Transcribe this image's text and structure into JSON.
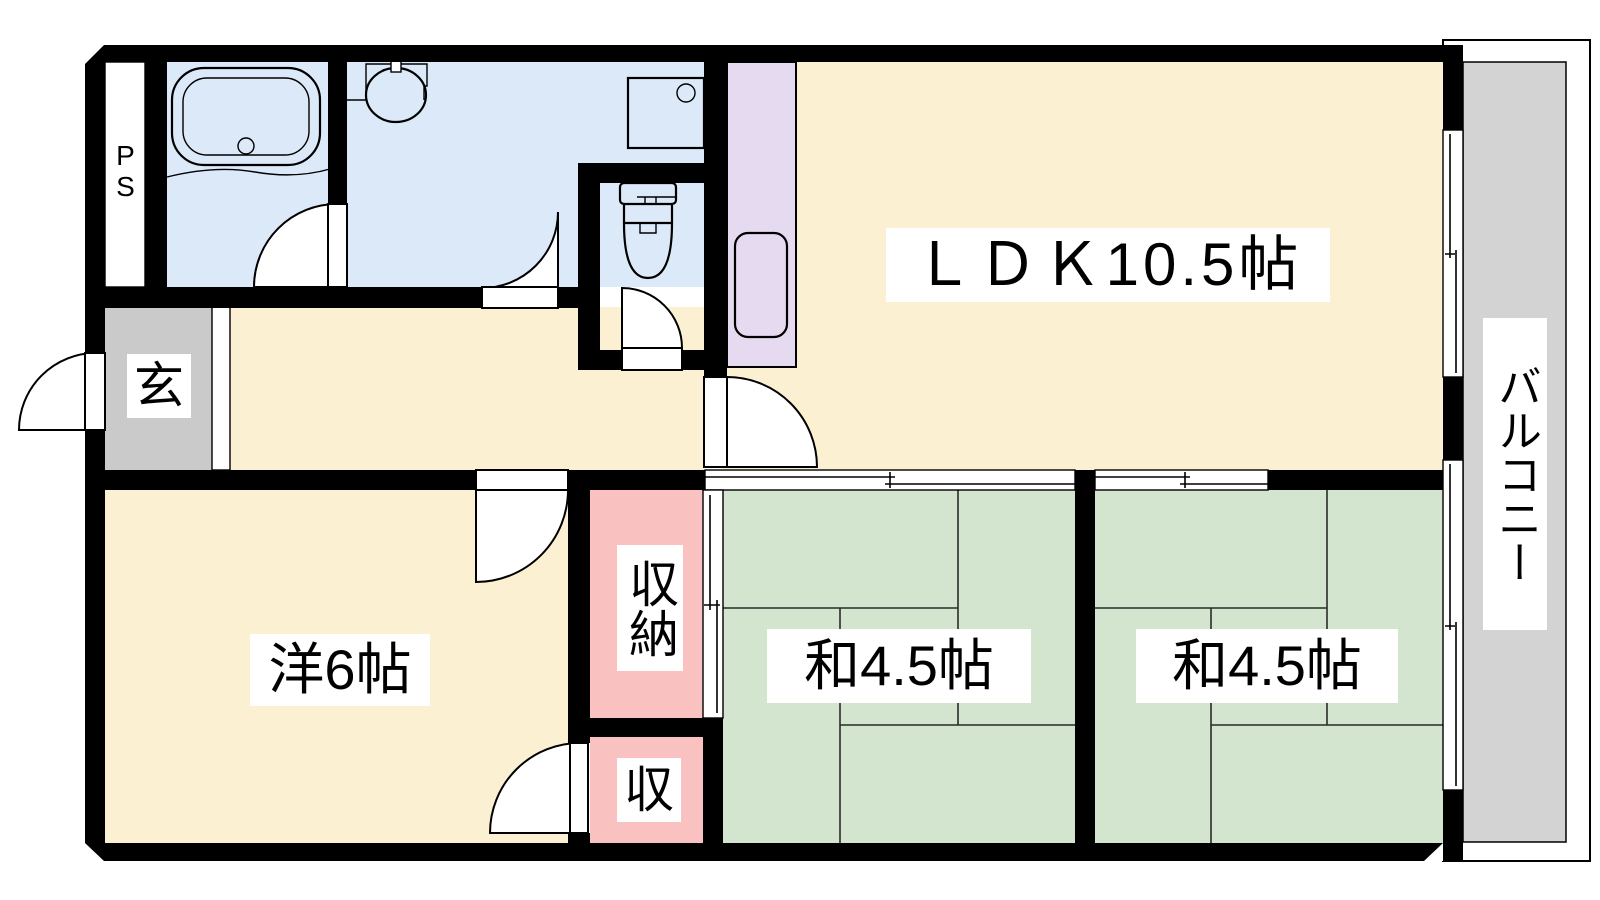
{
  "plan_title": "apartment-floor-plan",
  "rooms": {
    "ldk": {
      "label": "ＬＤＫ10.5帖"
    },
    "western_room": {
      "label": "洋6帖"
    },
    "tatami_room_1": {
      "label": "和4.5帖"
    },
    "tatami_room_2": {
      "label": "和4.5帖"
    },
    "closet_large": {
      "label": "収納"
    },
    "closet_small": {
      "label": "収"
    },
    "entrance": {
      "label": "玄"
    },
    "pipe_space": {
      "label": "PS"
    },
    "balcony": {
      "label": "バルコニー"
    }
  },
  "fixtures": [
    "bathtub",
    "wash-basin",
    "washing-machine-pan",
    "toilet",
    "kitchen-sink"
  ],
  "colors": {
    "room_cream": "#FCF0D2",
    "wet_blue": "#DCE9F8",
    "tatami_green": "#D3E5CE",
    "closet_pink": "#F9C1C0",
    "kitchen_purple": "#E6DAF0",
    "entrance_gray": "#CACACA",
    "balcony_gray": "#D3D3D3",
    "wall_black": "#000000"
  }
}
